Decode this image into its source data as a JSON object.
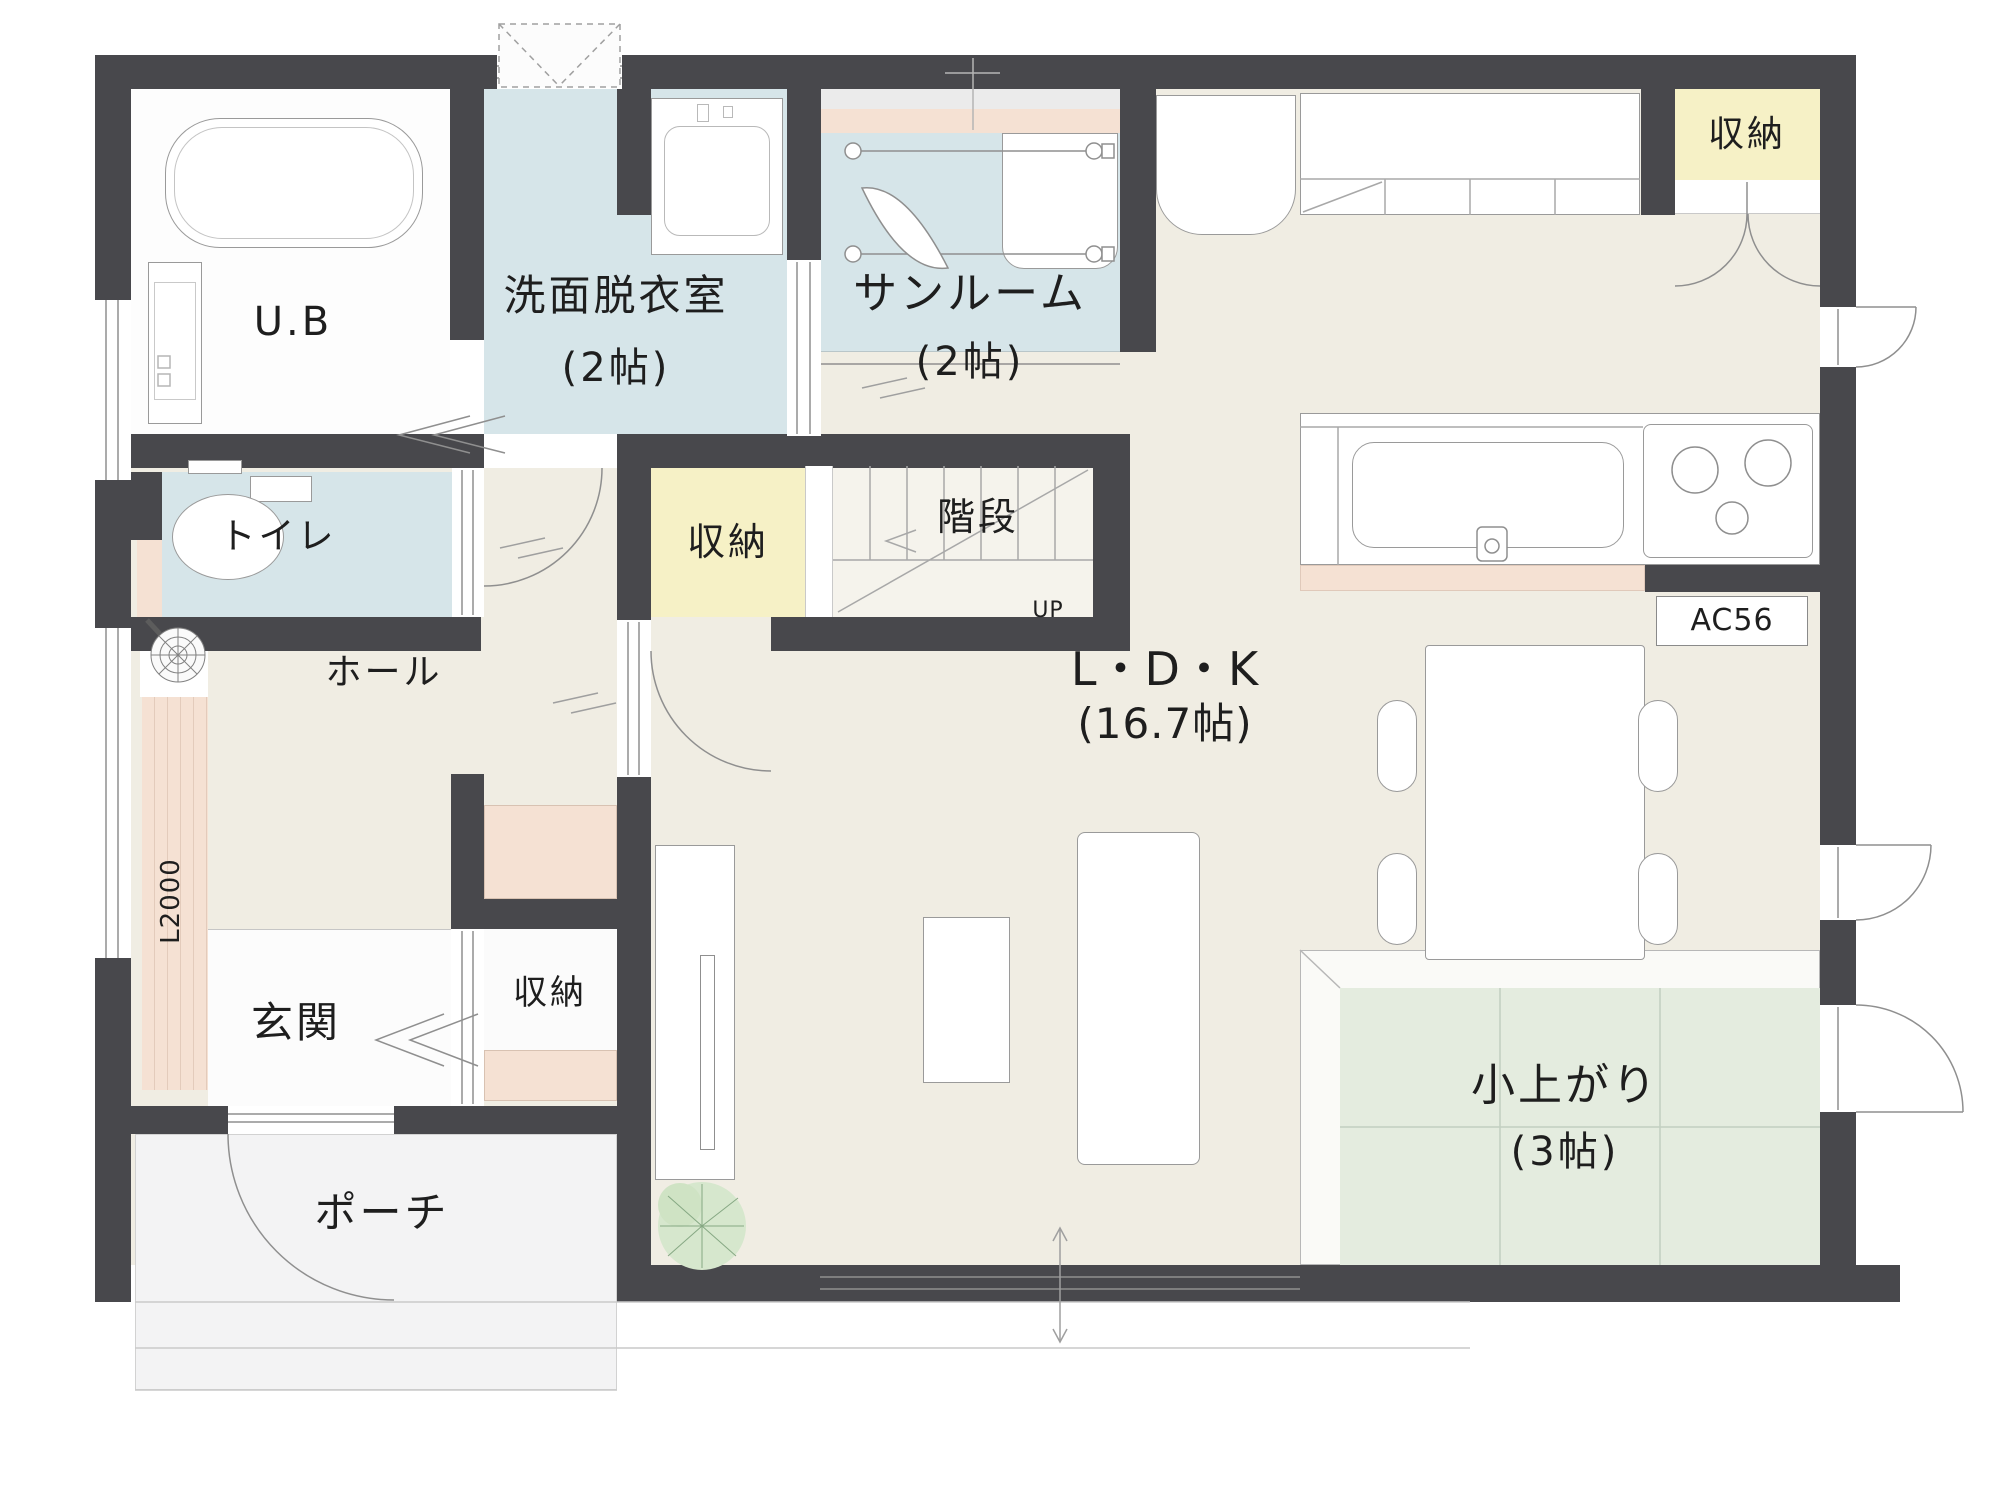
{
  "colors": {
    "wall": "#48484c",
    "floor": "#f0ede3",
    "wet": "#d6e5e9",
    "storage": "#f6f1c6",
    "tatami": "#e4ecdf",
    "wood": "#f5e1d3",
    "porch": "#f3f3f4",
    "stairfloor": "#f5f3ec",
    "line": "#9a9a9a",
    "ink": "#1e1e1e"
  },
  "rooms": {
    "ub": {
      "label": "U.B"
    },
    "senmen": {
      "label": "洗面脱衣室",
      "size": "(2帖)"
    },
    "sunroom": {
      "label": "サンルーム",
      "size": "(2帖)"
    },
    "toilet": {
      "label": "トイレ"
    },
    "hall": {
      "label": "ホール"
    },
    "stairs": {
      "label": "階段"
    },
    "storage_top": {
      "label": "収納"
    },
    "storage_center": {
      "label": "収納"
    },
    "storage_genkan": {
      "label": "収納"
    },
    "ldk": {
      "label": "L・D・K",
      "size": "(16.7帖)"
    },
    "genkan": {
      "label": "玄関"
    },
    "porch": {
      "label": "ポーチ"
    },
    "koagari": {
      "label": "小上がり",
      "size": "(3帖)"
    }
  },
  "annotations": {
    "stairs_up": "UP",
    "ac_unit": "AC56",
    "deck_length": "L2000"
  }
}
